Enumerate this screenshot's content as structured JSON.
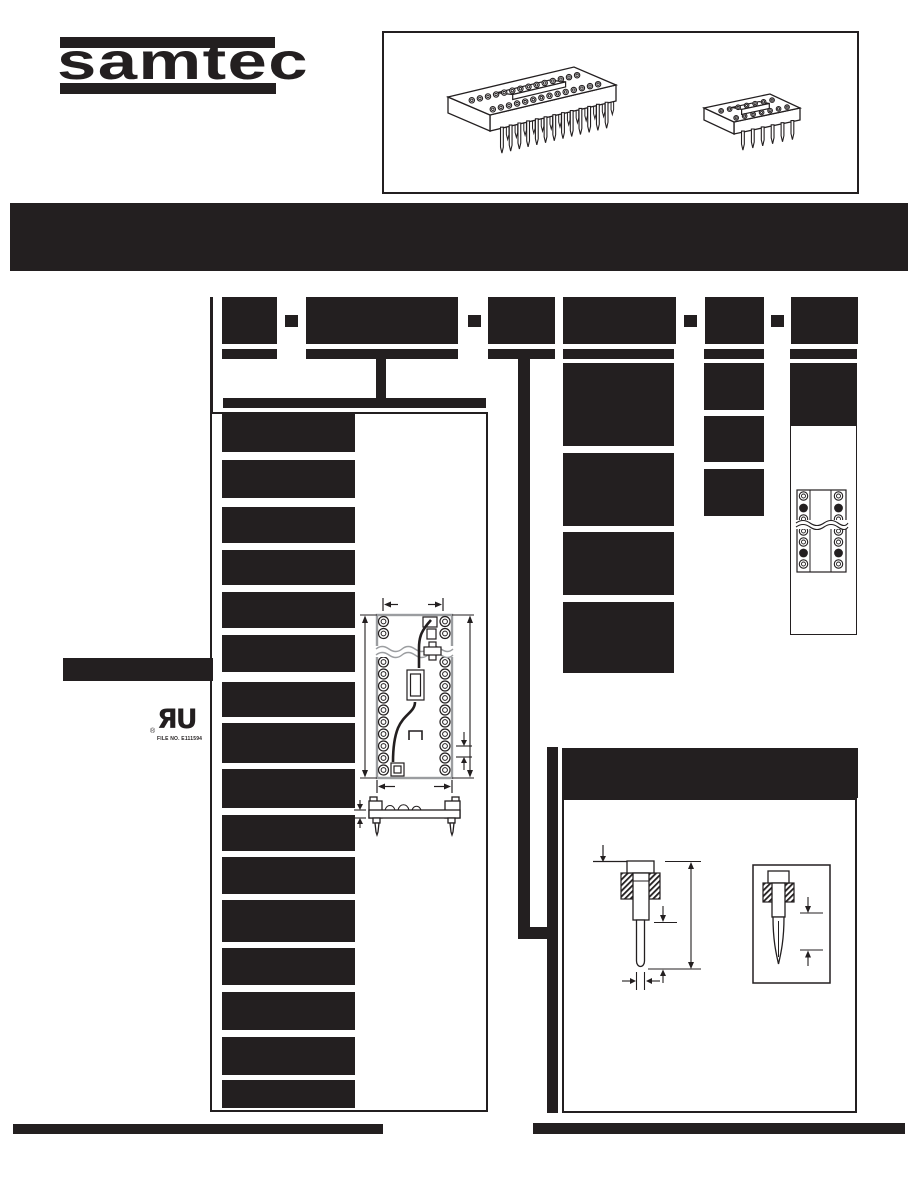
{
  "logo": {
    "text": "samtec"
  },
  "product_box": {
    "illustrations": [
      "wide-dip-socket-illustration",
      "narrow-dip-socket-illustration"
    ]
  },
  "title_banner": {
    "redacted": true
  },
  "part_number_builder": {
    "segment_count": 6,
    "separators": [
      "-",
      "-",
      "-",
      "-"
    ],
    "redacted": true
  },
  "ul_mark": {
    "glyphs": "ЯU",
    "registered_symbol": "®",
    "file_number": "FILE NO. E111594"
  },
  "icons": {
    "ul-recognized-component-mark": "ЯU",
    "dash-separator": "-"
  },
  "colors": {
    "ink": "#231f20",
    "line_gray": "#9b9da0",
    "paper": "#ffffff"
  }
}
